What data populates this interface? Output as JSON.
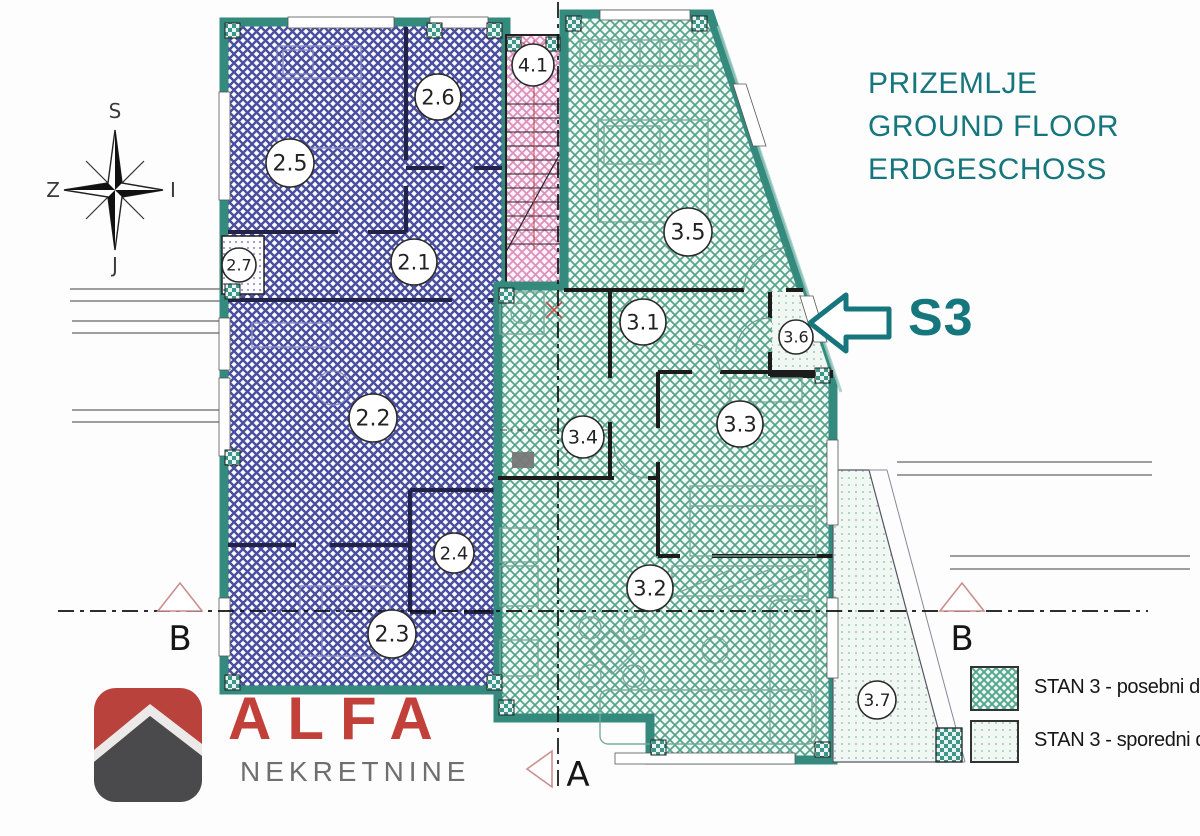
{
  "header": {
    "title_lines": [
      "PRIZEMLJE",
      "GROUND FLOOR",
      "ERDGESCHOSS"
    ]
  },
  "apartment_marker": {
    "label": "S3"
  },
  "compass": {
    "north": "S",
    "east": "I",
    "south": "J",
    "west": "Z"
  },
  "legend": {
    "items": [
      {
        "key": "posebni",
        "label": "STAN 3 - posebni dio"
      },
      {
        "key": "sporedni",
        "label": "STAN 3 - sporedni dio"
      }
    ]
  },
  "branding": {
    "name": "ALFA",
    "subtitle": "NEKRETNINE"
  },
  "floorplan": {
    "rooms": [
      {
        "id": "2.5",
        "cx": 290,
        "cy": 163,
        "r": 24
      },
      {
        "id": "2.6",
        "cx": 438,
        "cy": 97,
        "r": 23
      },
      {
        "id": "2.7",
        "cx": 239,
        "cy": 265,
        "r": 17
      },
      {
        "id": "2.1",
        "cx": 414,
        "cy": 262,
        "r": 23
      },
      {
        "id": "2.2",
        "cx": 373,
        "cy": 418,
        "r": 24
      },
      {
        "id": "2.4",
        "cx": 454,
        "cy": 553,
        "r": 20
      },
      {
        "id": "2.3",
        "cx": 392,
        "cy": 634,
        "r": 24
      },
      {
        "id": "4.1",
        "cx": 533,
        "cy": 65,
        "r": 21
      },
      {
        "id": "3.5",
        "cx": 688,
        "cy": 232,
        "r": 24
      },
      {
        "id": "3.1",
        "cx": 643,
        "cy": 322,
        "r": 23
      },
      {
        "id": "3.6",
        "cx": 796,
        "cy": 337,
        "r": 17
      },
      {
        "id": "3.4",
        "cx": 583,
        "cy": 437,
        "r": 21
      },
      {
        "id": "3.3",
        "cx": 740,
        "cy": 424,
        "r": 23
      },
      {
        "id": "3.2",
        "cx": 650,
        "cy": 588,
        "r": 23
      },
      {
        "id": "3.7",
        "cx": 877,
        "cy": 700,
        "r": 19
      }
    ],
    "section_markers": [
      {
        "label": "B"
      },
      {
        "label": "B"
      },
      {
        "label": "A"
      }
    ]
  },
  "colors": {
    "accent_teal": "#16767d",
    "wall_teal": "#358a7e",
    "hatch_blue": "#4a4f9f",
    "hatch_green": "#57a28c",
    "hatch_pink": "#dc8fbc",
    "section_pink": "#c98f8f",
    "brand_red": "#c2403a",
    "brand_gray": "#6f6f6f"
  }
}
